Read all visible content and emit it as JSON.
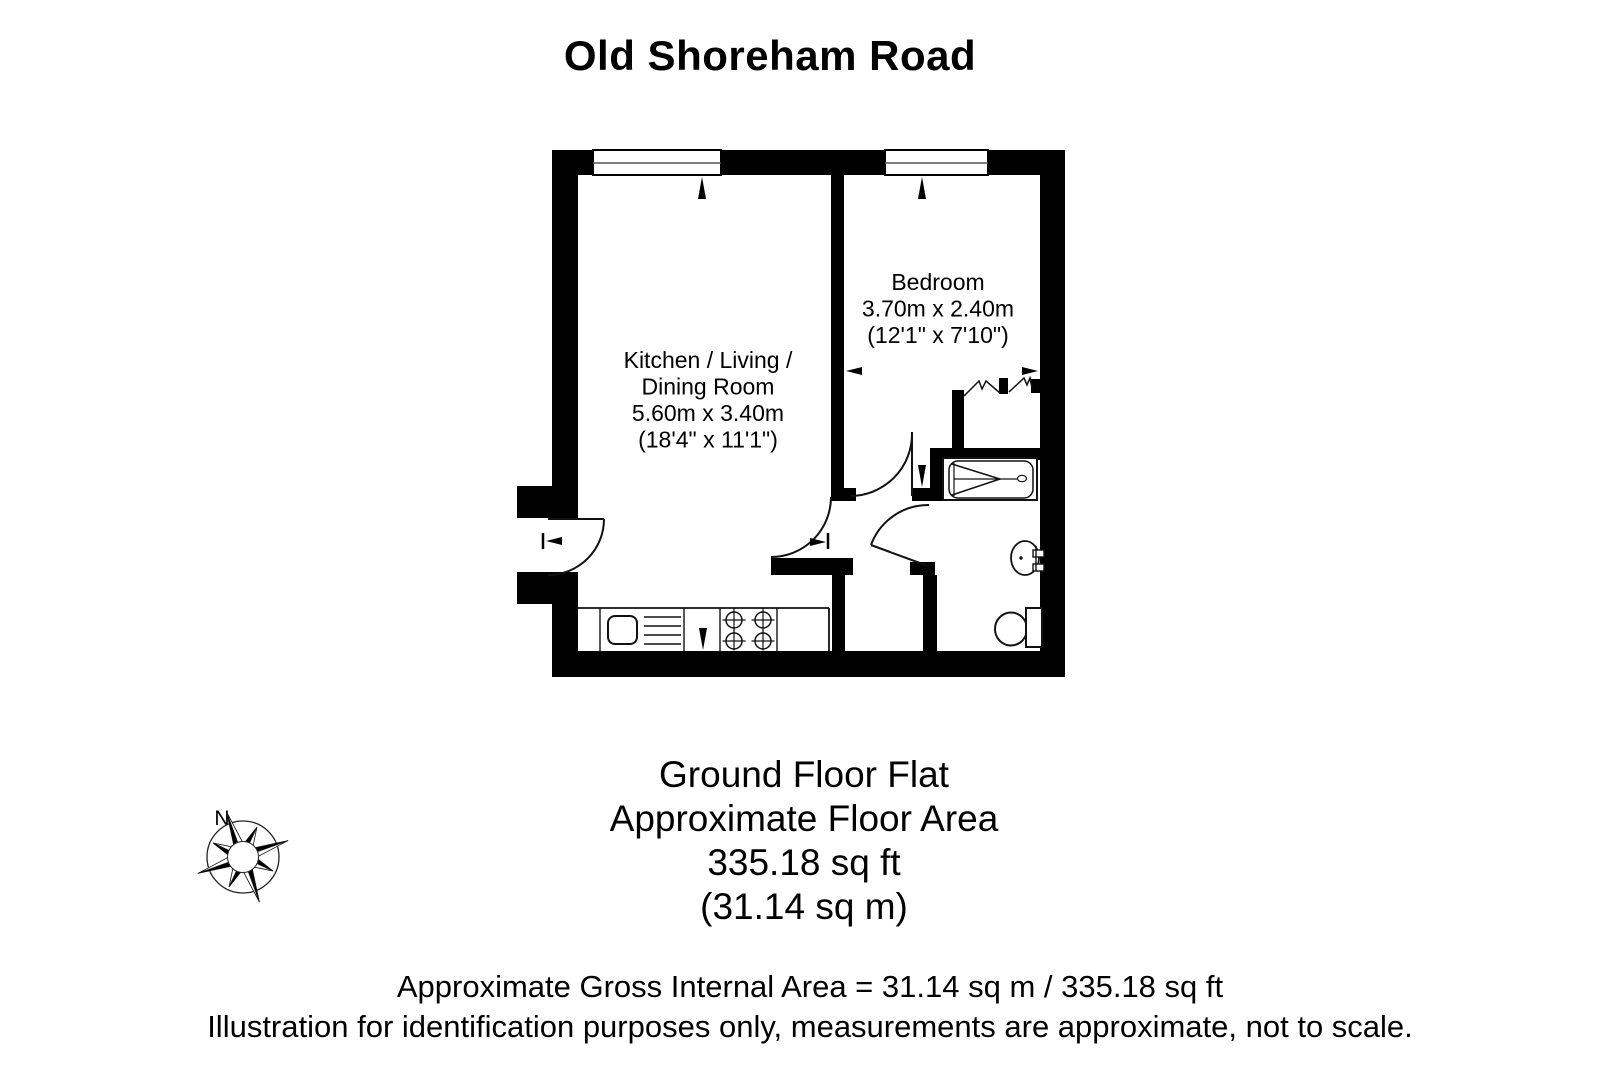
{
  "title": "Old Shoreham Road",
  "plan": {
    "room_living": {
      "line1": "Kitchen / Living /",
      "line2": "Dining Room",
      "line3": "5.60m x 3.40m",
      "line4": "(18'4\" x 11'1\")"
    },
    "room_bedroom": {
      "line1": "Bedroom",
      "line2": "3.70m x 2.40m",
      "line3": "(12'1\" x 7'10\")"
    }
  },
  "compass": {
    "north_label": "N"
  },
  "summary": {
    "line1": "Ground Floor Flat",
    "line2": "Approximate Floor Area",
    "line3": "335.18 sq ft",
    "line4": "(31.14 sq m)"
  },
  "footer": {
    "line1": "Approximate Gross Internal Area = 31.14 sq m / 335.18 sq ft",
    "line2": "Illustration for identification purposes only, measurements are approximate, not to scale."
  },
  "colors": {
    "wall": "#000000",
    "line": "#111111",
    "background": "#ffffff",
    "text": "#000000"
  }
}
